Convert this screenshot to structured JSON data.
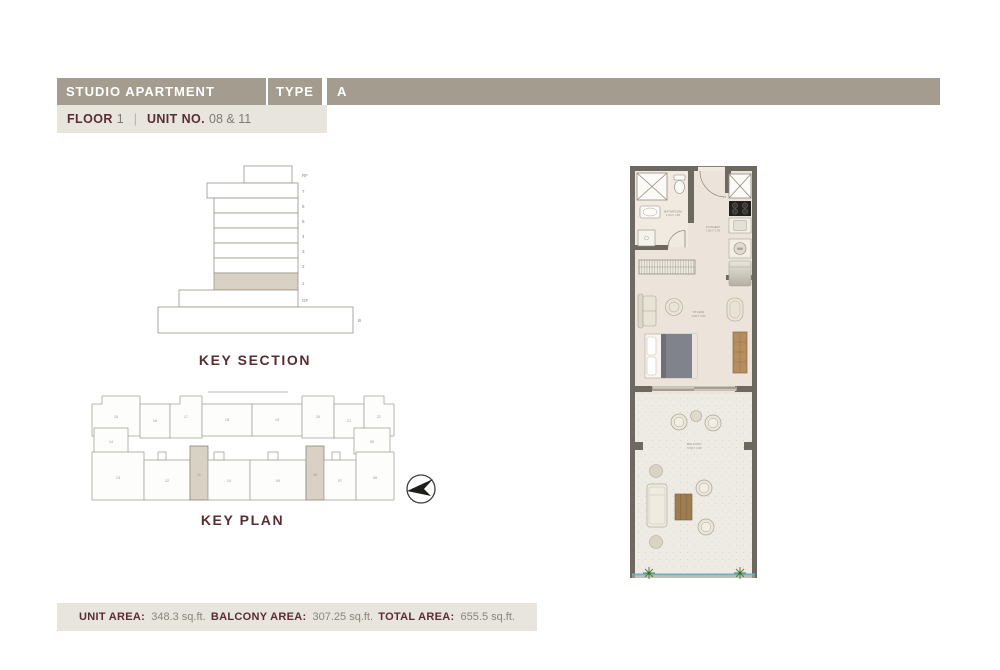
{
  "header": {
    "title": "STUDIO APARTMENT",
    "type_label": "TYPE",
    "type_value": "A"
  },
  "subheader": {
    "floor_label": "FLOOR",
    "floor_value": "1",
    "divider": "|",
    "unit_label": "UNIT NO.",
    "unit_value": "08 & 11"
  },
  "key_section": {
    "title": "KEY SECTION",
    "floor_labels": [
      "RF",
      "7",
      "6",
      "5",
      "4",
      "3",
      "2",
      "1",
      "GF"
    ],
    "basement_label": "B",
    "highlighted_floor": "1"
  },
  "key_plan": {
    "title": "KEY PLAN",
    "top_units": [
      "15",
      "16",
      "17",
      "18",
      "19",
      "20",
      "21",
      "22"
    ],
    "left_unit": "14",
    "right_unit": "05",
    "bottom_units": [
      "13",
      "12",
      "11",
      "10",
      "09",
      "08",
      "07",
      "06"
    ],
    "highlighted_units": [
      "11",
      "08"
    ]
  },
  "floor_plan": {
    "bathroom_name": "BATHROOM",
    "bathroom_dims": "2.1M X 1.9M",
    "kitchen_name": "KITCHEN",
    "kitchen_dims": "1.8M X 3.7M",
    "studio_name": "STUDIO",
    "studio_dims": "4.6M X 3.6M",
    "balcony_name": "BALCONY",
    "balcony_dims": "9.5M X 3.0M",
    "washing_machine_label": "WM"
  },
  "footer": {
    "areas": [
      {
        "label": "UNIT AREA:",
        "value": "348.3 sq.ft."
      },
      {
        "label": "BALCONY AREA:",
        "value": "307.25 sq.ft."
      },
      {
        "label": "TOTAL AREA:",
        "value": "655.5 sq.ft."
      }
    ]
  },
  "colors": {
    "header_bg": "#a59c90",
    "panel_bg": "#e8e5de",
    "accent_maroon": "#5a2d32",
    "wall": "#6e6960",
    "unit_floor": "#ece4da",
    "balcony_floor": "#edebe4",
    "highlight": "#d8d1c4",
    "glass_rail": "#76b0bc"
  }
}
